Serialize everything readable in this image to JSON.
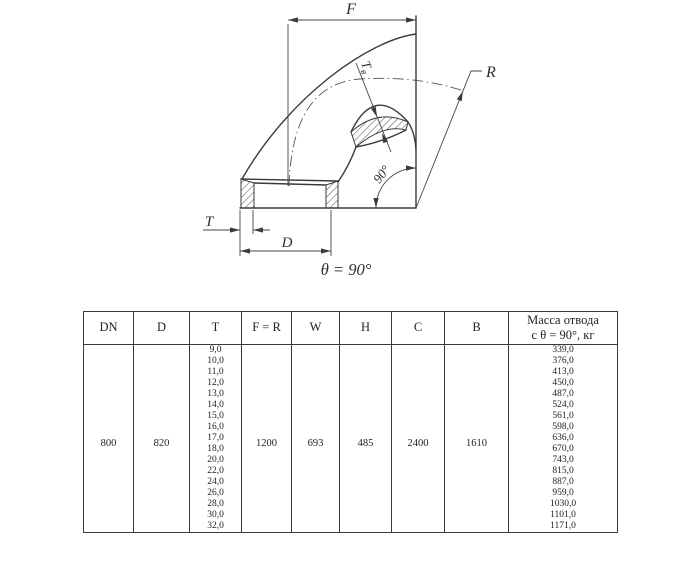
{
  "colors": {
    "line": "#3b3b3b",
    "text": "#222222",
    "bg": "#ffffff"
  },
  "drawing": {
    "labels": {
      "f": "F",
      "r": "R",
      "t": "T",
      "d": "D",
      "tv_main": "Т",
      "tv_sub": "в",
      "corner_angle": "90°",
      "caption": "θ = 90°"
    }
  },
  "table": {
    "headers": [
      "DN",
      "D",
      "T",
      "F = R",
      "W",
      "H",
      "C",
      "B",
      "Масса отвода\nс θ =  90°, кг"
    ],
    "row": {
      "dn": "800",
      "d": "820",
      "f_r": "1200",
      "w": "693",
      "h": "485",
      "c": "2400",
      "b": "1610"
    },
    "t_values": [
      "9,0",
      "10,0",
      "11,0",
      "12,0",
      "13,0",
      "14,0",
      "15,0",
      "16,0",
      "17,0",
      "18,0",
      "20,0",
      "22,0",
      "24,0",
      "26,0",
      "28,0",
      "30,0",
      "32,0"
    ],
    "mass_values": [
      "339,0",
      "376,0",
      "413,0",
      "450,0",
      "487,0",
      "524,0",
      "561,0",
      "598,0",
      "636,0",
      "670,0",
      "743,0",
      "815,0",
      "887,0",
      "959,0",
      "1030,0",
      "1101,0",
      "1171,0"
    ]
  }
}
